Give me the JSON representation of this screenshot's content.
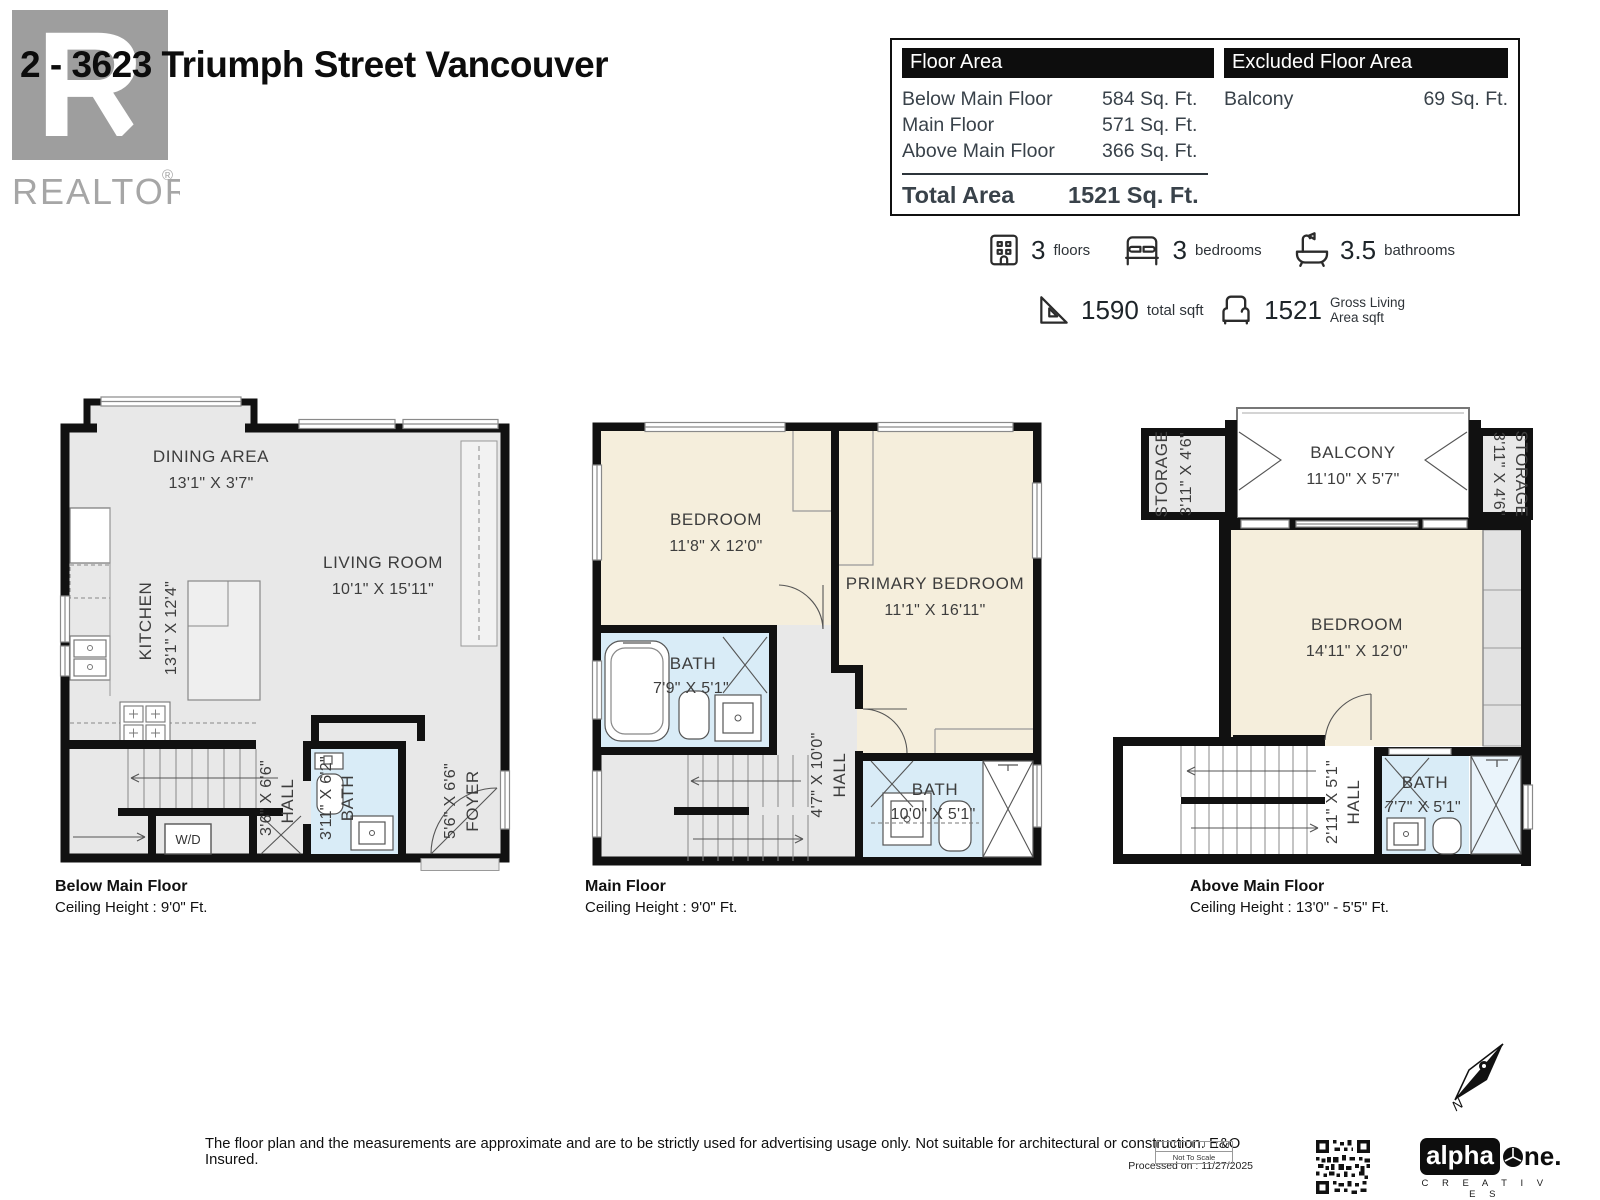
{
  "header": {
    "title": "2 - 3623 Triumph Street Vancouver",
    "logo_letter": "R",
    "logo_text": "REALTOR",
    "logo_mark": "®"
  },
  "area_table": {
    "floor_area_header": "Floor Area",
    "excluded_header": "Excluded Floor Area",
    "rows": [
      {
        "label": "Below Main Floor",
        "value": "584 Sq. Ft."
      },
      {
        "label": "Main Floor",
        "value": "571 Sq. Ft."
      },
      {
        "label": "Above Main Floor",
        "value": "366 Sq. Ft."
      }
    ],
    "total_label": "Total Area",
    "total_value": "1521 Sq. Ft.",
    "excluded_rows": [
      {
        "label": "Balcony",
        "value": "69 Sq. Ft."
      }
    ]
  },
  "stats": {
    "floors": {
      "value": "3",
      "label": "floors"
    },
    "bedrooms": {
      "value": "3",
      "label": "bedrooms"
    },
    "bathrooms": {
      "value": "3.5",
      "label": "bathrooms"
    },
    "total_sqft": {
      "value": "1590",
      "label": "total sqft"
    },
    "gross_living": {
      "value": "1521",
      "label_line1": "Gross Living",
      "label_line2": "Area sqft"
    }
  },
  "plans": [
    {
      "caption": "Below Main Floor",
      "ceiling": "Ceiling Height : 9'0\" Ft.",
      "rooms": {
        "dining": {
          "name": "DINING AREA",
          "dims": "13'1\" X 3'7\""
        },
        "kitchen": {
          "name": "KITCHEN",
          "dims": "13'1\" X 12'4\""
        },
        "living": {
          "name": "LIVING ROOM",
          "dims": "10'1\" X 15'11\""
        },
        "hall": {
          "name": "HALL",
          "dims": "3'6\" X 6'6\""
        },
        "bath": {
          "name": "BATH",
          "dims": "3'11\" X 6'2\""
        },
        "foyer": {
          "name": "FOYER",
          "dims": "5'6\" X 6'6\""
        },
        "wd": {
          "name": "W/D"
        }
      }
    },
    {
      "caption": "Main Floor",
      "ceiling": "Ceiling Height : 9'0\" Ft.",
      "rooms": {
        "bedroom": {
          "name": "BEDROOM",
          "dims": "11'8\" X 12'0\""
        },
        "primary": {
          "name": "PRIMARY BEDROOM",
          "dims": "11'1\" X 16'11\""
        },
        "bath_upper": {
          "name": "BATH",
          "dims": "7'9\" X 5'1\""
        },
        "hall": {
          "name": "HALL",
          "dims": "4'7\" X 10'0\""
        },
        "bath_lower": {
          "name": "BATH",
          "dims": "10'0\" X 5'1\""
        }
      }
    },
    {
      "caption": "Above Main Floor",
      "ceiling": "Ceiling Height : 13'0\" - 5'5\" Ft.",
      "rooms": {
        "storage_left": {
          "name": "STORAGE",
          "dims": "3'11\" X 4'6\""
        },
        "balcony": {
          "name": "BALCONY",
          "dims": "11'10\" X 5'7\""
        },
        "storage_right": {
          "name": "STORAGE",
          "dims": "3'11\" X 4'6\""
        },
        "bedroom": {
          "name": "BEDROOM",
          "dims": "14'11\" X 12'0\""
        },
        "hall": {
          "name": "HALL",
          "dims": "2'11\" X 5'1\""
        },
        "bath": {
          "name": "BATH",
          "dims": "7'7\" X 5'1\""
        }
      }
    }
  ],
  "footer": {
    "disclaimer": "The floor plan and the measurements are approximate and are to be strictly used for advertising usage only. Not suitable for architectural or construction. E&O Insured.",
    "processed": "Processed on : 11/27/2025",
    "not_to_scale": "Not To Scale",
    "brand_alpha": "alpha",
    "brand_one": "ne.",
    "brand_sub": "C R E A T I V E S",
    "compass_letter": "N"
  },
  "colors": {
    "wall": "#111111",
    "floor_gray": "#e8e8e8",
    "bedroom_beige": "#f5eedc",
    "bath_blue": "#d9ecf7",
    "table_text": "#39424a"
  }
}
